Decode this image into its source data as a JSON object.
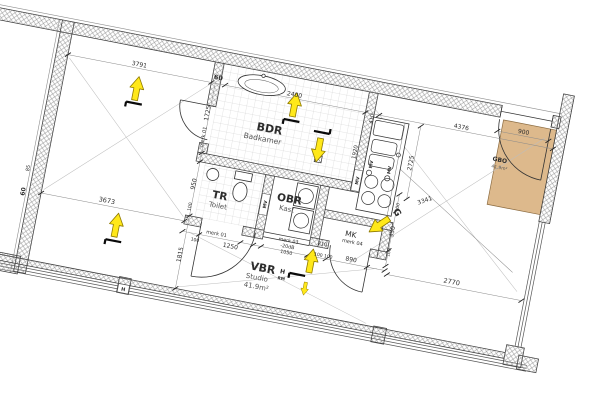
{
  "meta": {
    "type": "architectural-floor-plan",
    "language": "nl"
  },
  "rooms": {
    "bdr": {
      "code": "BDR",
      "name": "Badkamer"
    },
    "tr": {
      "code": "TR",
      "name": "Toilet"
    },
    "obr": {
      "code": "OBR",
      "name": "Kast"
    },
    "mk": {
      "code": "MK"
    },
    "vbr": {
      "code": "VBR",
      "name": "Studio",
      "area": "41.9m²"
    },
    "gbo": {
      "code": "GBO",
      "area": "41.9m²"
    }
  },
  "dims": {
    "t3791": "3791",
    "t60": "60",
    "t2400": "2400",
    "t410": "410",
    "t4376": "4376",
    "t900": "900",
    "t1725": "1725",
    "tmerk01a": "merk 01",
    "t950": "950",
    "t100a": "100",
    "t1815": "1815",
    "t3673": "3673",
    "t85": "85",
    "t60l": "60",
    "tmerk01b": "merk 01",
    "t100b": "100",
    "t1250": "1250",
    "tmerk03": "merk 03",
    "tm20db": "-20dB",
    "t1050": "1050",
    "t210": "210",
    "t100pair": "100 100",
    "t890": "890",
    "tmerk04": "merk 04",
    "t100c": "100",
    "t350": "350",
    "t100d": "100",
    "t1920": "1920",
    "t2725": "2725",
    "t3341": "3341",
    "t2770": "2770"
  },
  "markers": {
    "mv": "MV",
    "gas": "G",
    "h": "H",
    "rm": "RM"
  },
  "colors": {
    "arrow_fill": "#ffe81a",
    "entry_zone_fill": "#ddb98c"
  }
}
